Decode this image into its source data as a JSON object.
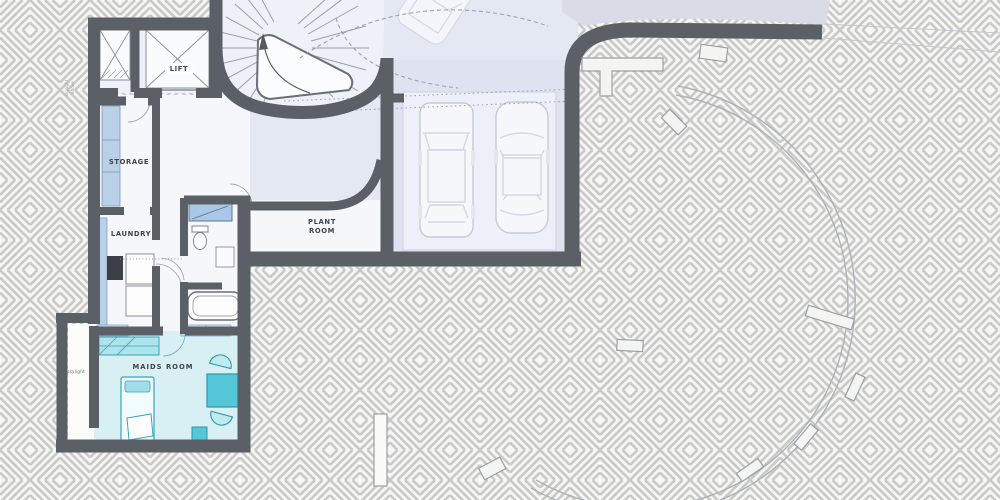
{
  "plan": {
    "rooms": {
      "lift": "LIFT",
      "storage": "STORAGE",
      "laundry": "LAUNDRY",
      "plant_room_line1": "PLANT",
      "plant_room_line2": "ROOM",
      "maids_room": "MAIDS ROOM",
      "skylight": "skylight"
    },
    "annotations": {
      "side_note_line1": "skylight",
      "side_note_line2": "above"
    },
    "colors": {
      "wall": "#5a6066",
      "hatch_line": "#c9c9c7",
      "paper": "#f6f6f4",
      "driveway": "#e4e8f3",
      "stair_floor": "#eef1f8",
      "room_floor": "#f5f7fb",
      "shaft_floor": "#eef1f7",
      "garage_floor": "#dfe3f1",
      "garage_inner": "#edf0f8",
      "maids_floor": "#d8eff3",
      "corridor_floor": "#fcfcfa",
      "teal": "#54c8d8",
      "teal_light": "#aee3ec",
      "teal_dark": "#2d98a8",
      "shelf_blue": "#b9d0e8",
      "vanity_blue": "#a9c7e7",
      "appliance_dark": "#3c4147",
      "wedge": "#d9dce7",
      "arc_line": "#aeb2b8",
      "label": "#3f444c"
    }
  }
}
